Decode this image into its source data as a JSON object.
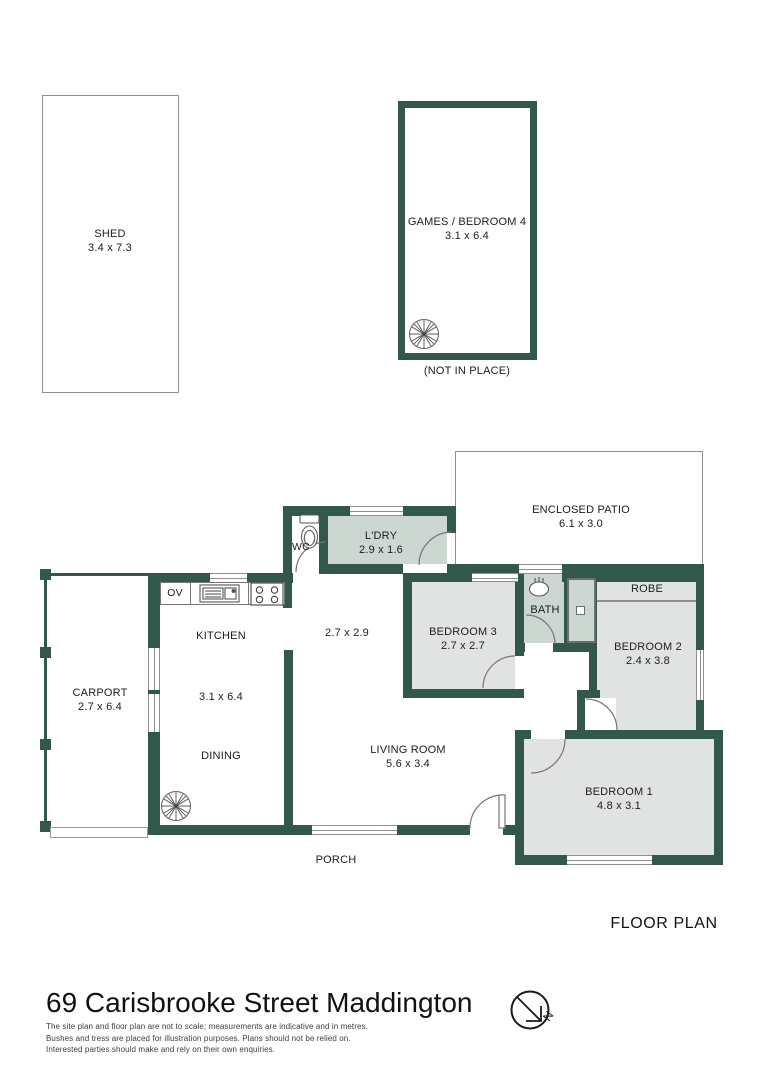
{
  "rooms": {
    "shed": {
      "name": "SHED",
      "dims": "3.4 x 7.3"
    },
    "games": {
      "name": "GAMES / BEDROOM 4",
      "dims": "3.1 x 6.4",
      "note": "(NOT IN PLACE)"
    },
    "patio": {
      "name": "ENCLOSED PATIO",
      "dims": "6.1 x 3.0"
    },
    "laundry": {
      "name": "L'DRY",
      "dims": "2.9 x 1.6"
    },
    "wc": {
      "name": "WC"
    },
    "hall": {
      "dims": "2.7 x 2.9"
    },
    "kitchen": {
      "name": "KITCHEN",
      "dims": "3.1 x 6.4",
      "dining": "DINING",
      "oven": "OV"
    },
    "carport": {
      "name": "CARPORT",
      "dims": "2.7 x 6.4"
    },
    "bedroom3": {
      "name": "BEDROOM 3",
      "dims": "2.7 x 2.7"
    },
    "bath": {
      "name": "BATH"
    },
    "robe": {
      "name": "ROBE"
    },
    "bedroom2": {
      "name": "BEDROOM 2",
      "dims": "2.4 x 3.8"
    },
    "living": {
      "name": "LIVING ROOM",
      "dims": "5.6 x 3.4"
    },
    "bedroom1": {
      "name": "BEDROOM 1",
      "dims": "4.8 x 3.1"
    },
    "porch": {
      "name": "PORCH"
    }
  },
  "footer": {
    "plan_label": "FLOOR PLAN",
    "address": "69 Carisbrooke Street Maddington",
    "disclaimer_lines": [
      "The site plan and floor plan are not to scale; measurements are indicative and in metres.",
      "Bushes and tress are placed for illustration purposes. Plans should not be relied on.",
      "Interested parties should make and rely on their own enquiries."
    ],
    "compass": "N"
  },
  "colors": {
    "wall": "#31584a",
    "laundry_bath_fill": "#ccd7d1",
    "bedroom_fill": "#e0e3e2",
    "outline": "#8f8f8f"
  }
}
